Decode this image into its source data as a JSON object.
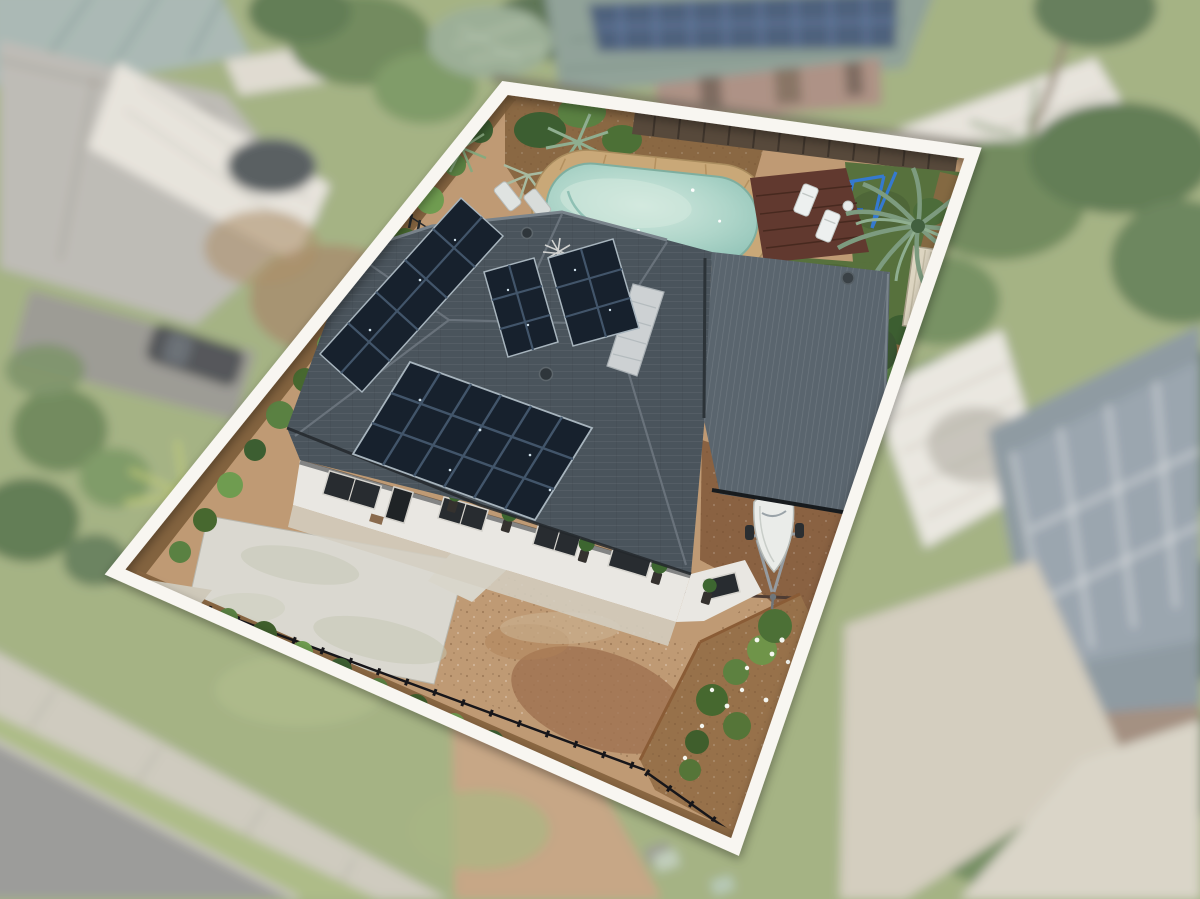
{
  "meta": {
    "type": "aerial-drone-photograph",
    "subject": "Single-storey home with rooftop solar panels, backyard swimming pool, timber deck and a boat on a trailer, shown from above",
    "style": "real-estate listing image: property parcel outlined with a thick white tilted rectangle, interior sharp and saturated, surrounding neighbourhood blurred"
  },
  "outline": {
    "points": "505,88 973,153 735,847 115,572",
    "stroke_width": 13
  },
  "property": {
    "features": [
      "dark blue-grey tiled hip roof",
      "five rooftop solar panel arrays",
      "roof vents and TV antenna",
      "whitish skylight strip on roof",
      "oval swimming pool with stone coping",
      "timber pool deck with two white sun loungers",
      "two white lounge chairs on pavers",
      "blue kids swing set on back lawn",
      "timber back fence",
      "cream corrugated water tank",
      "silvery palm trees",
      "white rendered front walls with dark windows",
      "potted topiary plants along facade",
      "light concrete pad",
      "exposed-aggregate driveway with red-brown stains",
      "white boat on galvanised trailer under carport wing",
      "mulched garden beds with shrubs and white flowers",
      "black metal garden edging fence",
      "hedge row along left boundary"
    ]
  },
  "surroundings": {
    "features": [
      "left neighbour with grey tiled roof, white awning, trampoline and dark parked car",
      "top neighbour with green metal roof and navy solar array, brick walls, white patio awning",
      "right neighbour with blue-grey metal roof, large pale solar array and white ribbed roof section",
      "street with kerb, concrete footpath and green verge at bottom-left",
      "aggregate driveway crossing the verge",
      "stepping stones on lawn",
      "dense trees and tall palms around the block"
    ]
  },
  "colors": {
    "outline_white": "#f8f6f1",
    "haze": "#f2f0ea",
    "main_roof": "#4a545c",
    "roof_ridge": "#79838b",
    "roof_facet": "#6e7880",
    "eave_shadow": "#23282c",
    "wing_roof": "#5a656e",
    "solar_dark": "#17212d",
    "solar_grid": "#42556a",
    "solar_frame": "#a7b4bd",
    "skylight": "#cdd1d3",
    "pool_coping": "#c9a878",
    "pool_water": "#9ccac0",
    "pool_water_light": "#d3e9df",
    "deck_wood": "#61392f",
    "deck_plank": "#47291f",
    "lawn": "#57713d",
    "lawn_dark": "#4a6336",
    "lawn_sliver": "#77875a",
    "mulch": "#8a6843",
    "fence_wood": "#57493b",
    "fence_slat": "#3e342b",
    "wall_white": "#e9e7e2",
    "window_dark": "#282c30",
    "window_frame": "#d6d4ce",
    "door_dark": "#1f2326",
    "pot_dark": "#34312e",
    "plant_dark": "#3d6630",
    "plant_light": "#5d8c44",
    "concrete_pad": "#dad8d0",
    "path_concrete": "#d4cfc2",
    "aggregate": "#bf9a74",
    "aggregate_red": "#9f7050",
    "dirt_red": "#8a6242",
    "bed_mulch": "#97714a",
    "garden_fence": "#17161a",
    "hedge_dark": "#3c5e31",
    "hedge_mid": "#5a8142",
    "hedge_light": "#6f9c50",
    "palm_silver": "#7d9b7f",
    "palm_bright": "#8fae90",
    "tank_cream": "#ddd5c1",
    "boat_white": "#eaece9",
    "boat_stroke": "#b5bab6",
    "trailer_gray": "#959ba0",
    "wheel_dark": "#2a2e31",
    "swing_blue": "#3579cf",
    "chair_white": "#edf0ef",
    "bg_lawn": "#98a873",
    "bg_lawn_light": "#a3b377",
    "street_gray": "#8e8e8c",
    "curb_light": "#c2bfb6",
    "sidewalk": "#c9c5b8",
    "bg_drive_tan": "#c09a74",
    "bg_roof_gray": "#b6b3ad",
    "bg_roof_teal": "#9fb0ac",
    "bg_awning": "#e6e2da",
    "bg_white_band": "#ddd8cd",
    "bg_roof_green": "#80948b",
    "bg_solar_navy": "#31486b",
    "bg_solar_line": "#5a76a6",
    "bg_brick": "#a38275",
    "bg_roof_blue": "#7e8c96",
    "bg_solar_blue": "#8c99a5",
    "bg_white_roof": "#e9e6df",
    "bg_concrete": "#cfc8b8",
    "tree_dark": "#4c6a3e",
    "tree_mid": "#5d7a47",
    "tree_light": "#6d8d53",
    "palm_yellow": "#b9c566",
    "car_dark": "#3a3e42",
    "trampoline_dark": "#41474b",
    "bg_fence": "#5f5548",
    "stone_pale": "#b9c9b4"
  }
}
